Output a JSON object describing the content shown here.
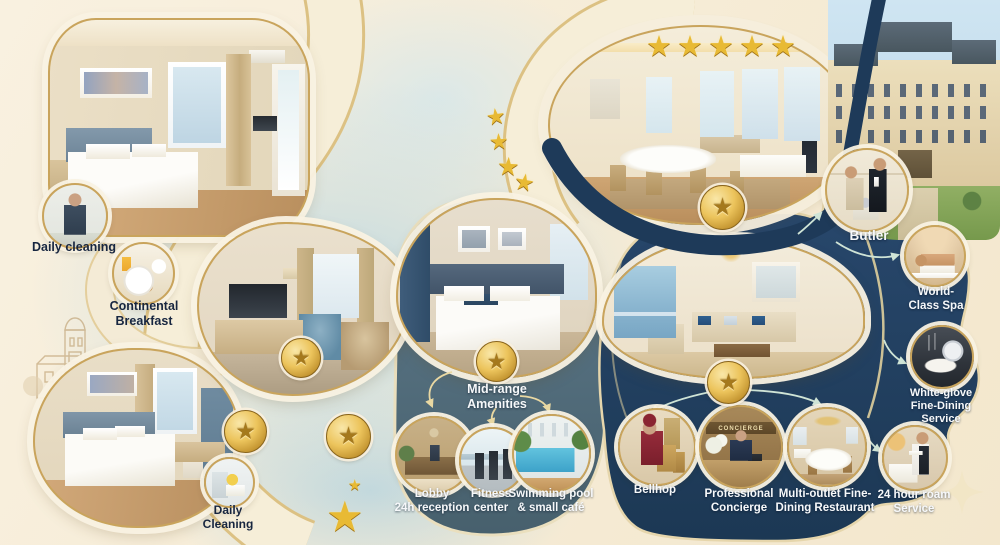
{
  "palette": {
    "background_cream": "#f7efdc",
    "pale_blue": "#cfe3ea",
    "midrange_panel": "#56707f",
    "luxury_panel": "#24405f",
    "navy_ribbon": "#1e3a59",
    "gold_border": "#c9a45c",
    "star_gold": "#e8ba34",
    "text_dark": "#172640",
    "text_light": "#f6f8fa"
  },
  "budget": {
    "daily_cleaning_top": "Daily cleaning",
    "continental_breakfast": "Continental\nBreakfast",
    "daily_cleaning_bottom": "Daily\nCleaning"
  },
  "midrange": {
    "heading": "Mid-range\nAmenities",
    "lobby": "Lobby\n24h reception",
    "fitness": "Fitness\ncenter",
    "pool": "Swimming pool\n& small café"
  },
  "luxury": {
    "star_count": 5,
    "butler": "Butler",
    "spa": "World-\nClass Spa",
    "fine_dining": "White-glove\nFine-Dining\nService",
    "room_service": "24 hour roam\nService",
    "bellhop": "Bellhop",
    "concierge": "Professional\nConcierge",
    "restaurant": "Multi-outlet Fine-\nDining Restaurant",
    "concierge_sign": "CONCIERGE"
  }
}
